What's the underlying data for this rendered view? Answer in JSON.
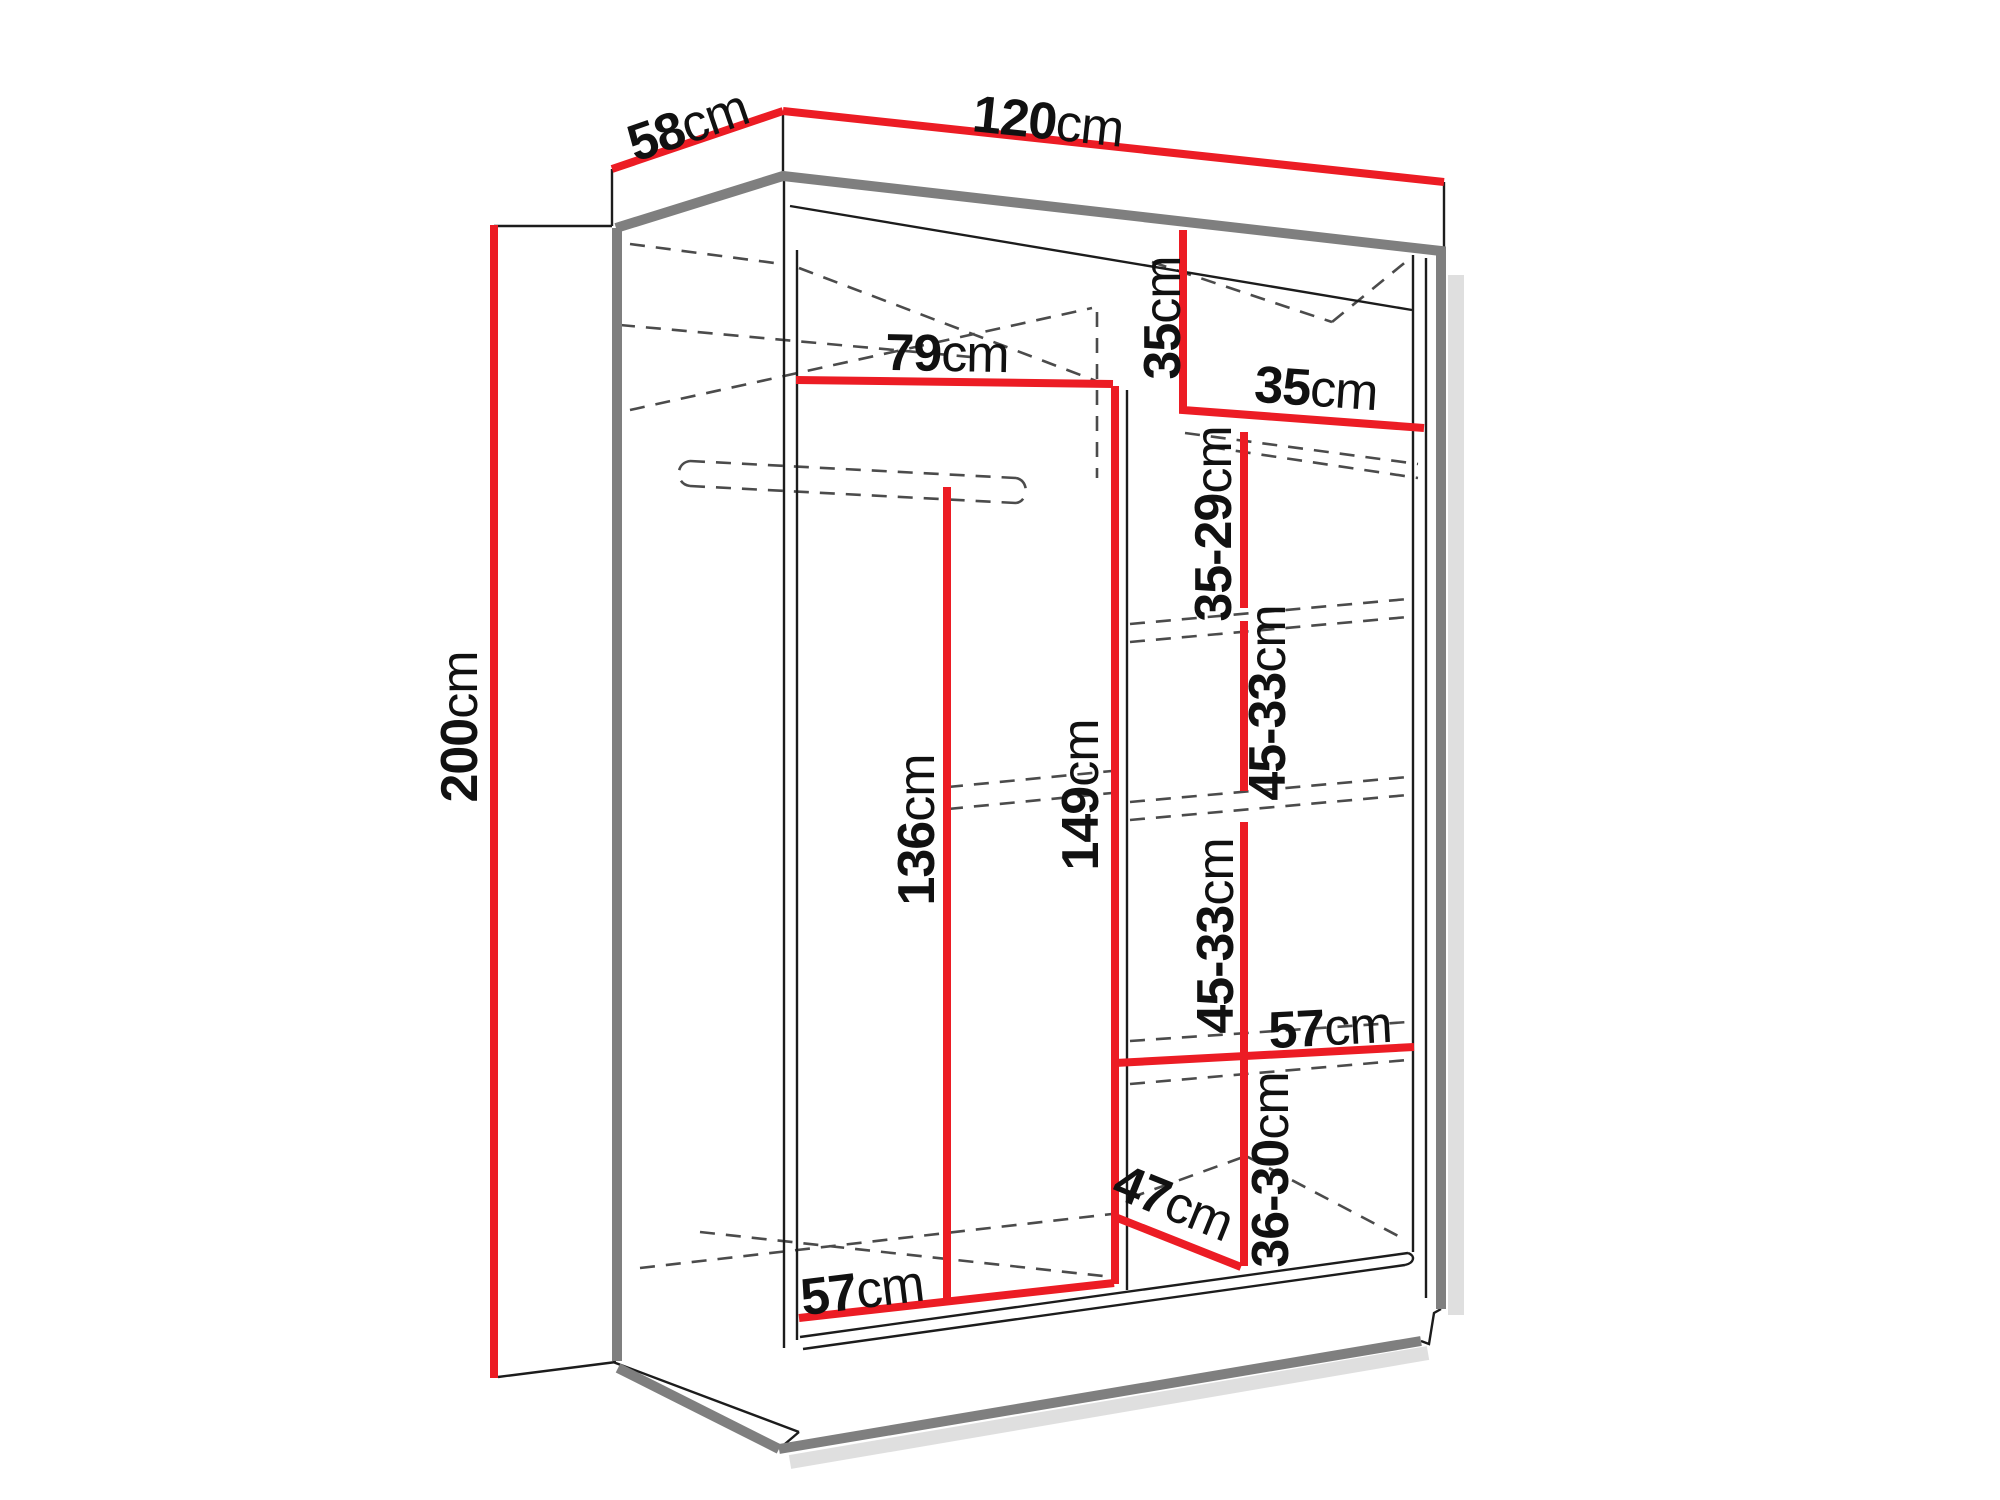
{
  "diagram": {
    "type": "furniture-dimension-diagram",
    "subject": "sliding-door wardrobe interior dimensions",
    "unit": "cm",
    "colors": {
      "dimension_line": "#ec1c24",
      "thick_edge": "#7f7f7f",
      "thin_edge": "#1c1c1c",
      "hidden_edge": "#4b4b4b",
      "label_text": "#111111",
      "background": "#ffffff"
    },
    "dimensions": [
      {
        "id": "top-depth",
        "value": "58",
        "unit": "cm",
        "x": 688,
        "y": 126,
        "rotation": -19
      },
      {
        "id": "top-width",
        "value": "120",
        "unit": "cm",
        "x": 1048,
        "y": 122,
        "rotation": 6
      },
      {
        "id": "height-left",
        "value": "200",
        "unit": "cm",
        "x": 460,
        "y": 727,
        "rotation": -90
      },
      {
        "id": "left-section-width",
        "value": "79",
        "unit": "cm",
        "x": 947,
        "y": 354,
        "rotation": 1
      },
      {
        "id": "top-right-compartment-height",
        "value": "35",
        "unit": "cm",
        "x": 1163,
        "y": 318,
        "rotation": -90
      },
      {
        "id": "right-section-width",
        "value": "35",
        "unit": "cm",
        "x": 1316,
        "y": 389,
        "rotation": 4
      },
      {
        "id": "right-shelf-gap-1",
        "value": "35-29",
        "unit": "cm",
        "x": 1214,
        "y": 524,
        "rotation": -90
      },
      {
        "id": "right-shelf-gap-2",
        "value": "45-33",
        "unit": "cm",
        "x": 1268,
        "y": 703,
        "rotation": -90
      },
      {
        "id": "hanging-space-height",
        "value": "136",
        "unit": "cm",
        "x": 917,
        "y": 830,
        "rotation": -90
      },
      {
        "id": "center-section-height",
        "value": "149",
        "unit": "cm",
        "x": 1081,
        "y": 795,
        "rotation": -90
      },
      {
        "id": "right-shelf-gap-3",
        "value": "45-33",
        "unit": "cm",
        "x": 1216,
        "y": 936,
        "rotation": -90
      },
      {
        "id": "right-lower-shelf-width",
        "value": "57",
        "unit": "cm",
        "x": 1330,
        "y": 1028,
        "rotation": -3
      },
      {
        "id": "right-shelf-gap-4",
        "value": "36-30",
        "unit": "cm",
        "x": 1271,
        "y": 1170,
        "rotation": -90
      },
      {
        "id": "bottom-diagonal-depth",
        "value": "47",
        "unit": "cm",
        "x": 1173,
        "y": 1203,
        "rotation": 22
      },
      {
        "id": "bottom-left-width",
        "value": "57",
        "unit": "cm",
        "x": 862,
        "y": 1291,
        "rotation": -7
      }
    ]
  }
}
